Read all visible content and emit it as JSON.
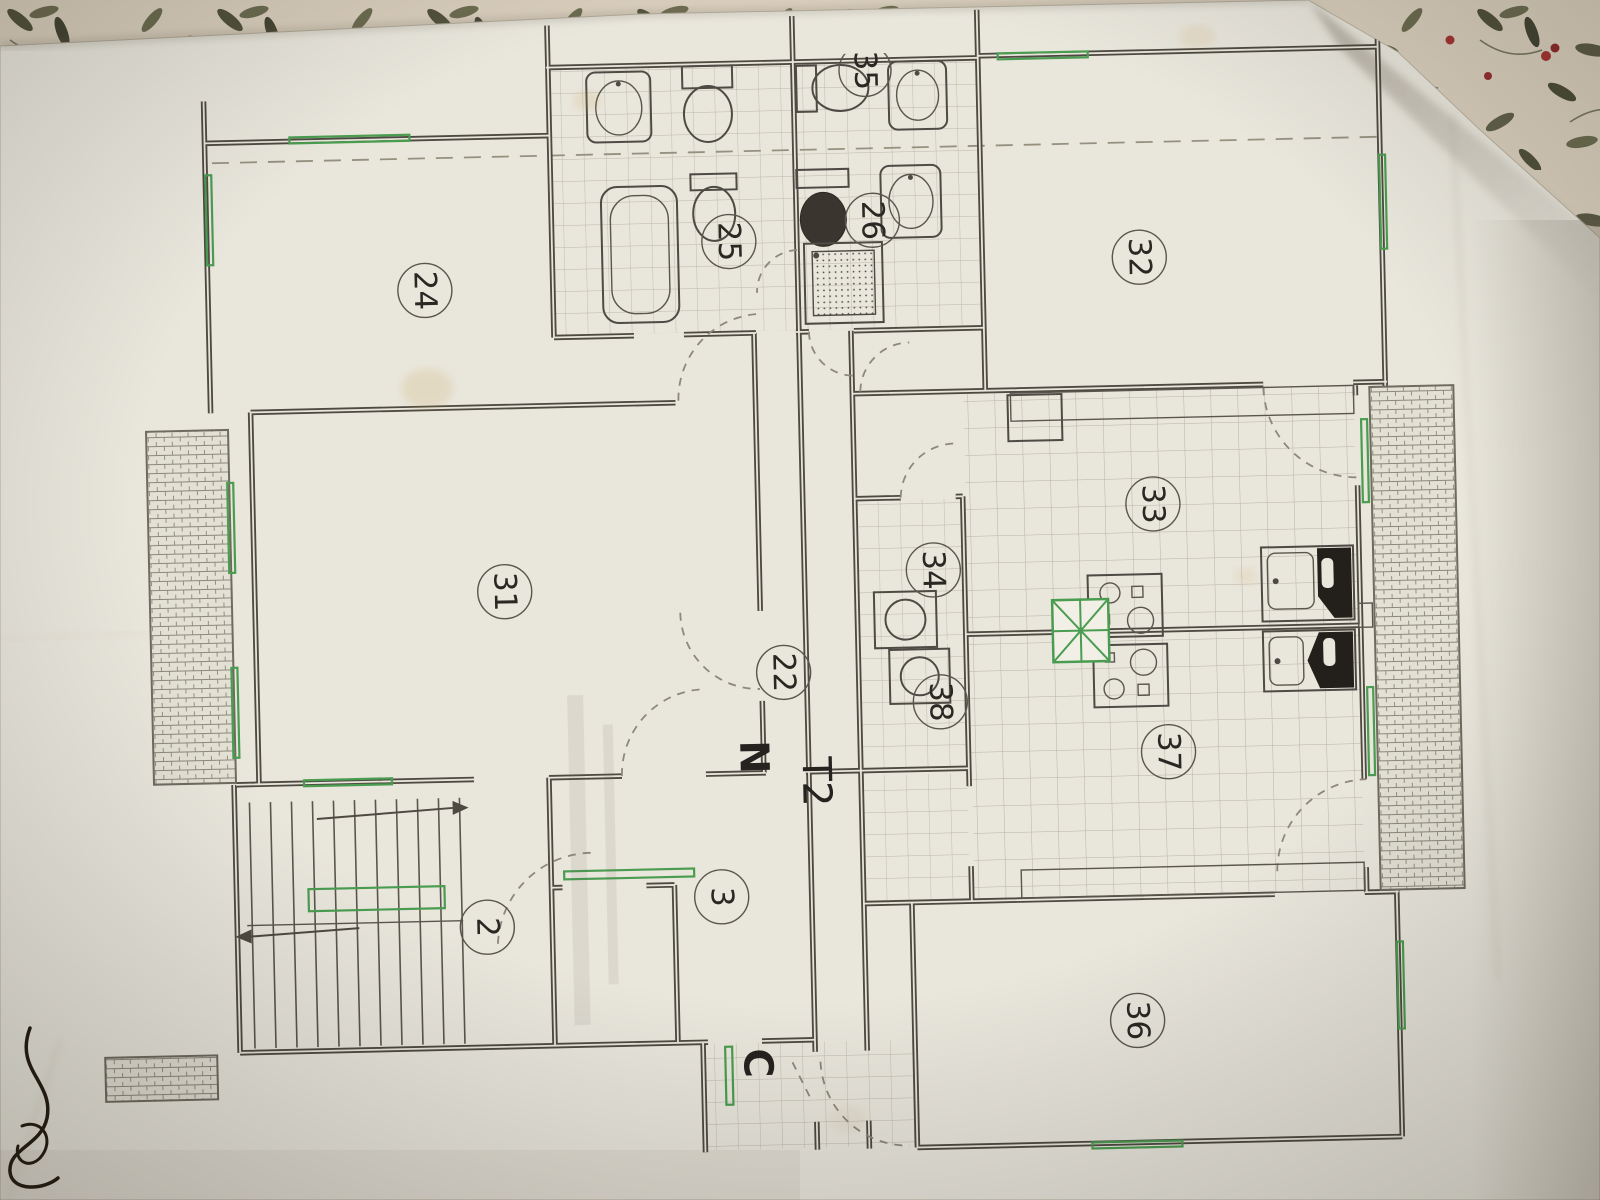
{
  "plan": {
    "unit_label": "T2",
    "north_label": "N",
    "corridor_label": "C",
    "room_numbers": {
      "r2": "2",
      "r3": "3",
      "r22": "22",
      "r24": "24",
      "r25": "25",
      "r26": "26",
      "r31": "31",
      "r32": "32",
      "r33": "33",
      "r34": "34",
      "r35": "35",
      "r36": "36",
      "r37": "37",
      "r38": "38"
    }
  },
  "colors": {
    "paper": "#e9e6dc",
    "plan_line": "#4e4a42",
    "marking_green": "#4a9c50",
    "tile_grid": "#bdb7a9",
    "dashed_section_line": "#96917f",
    "fabric_base": "#d9cebc",
    "fabric_leaf": "#4a4a36",
    "fabric_berry": "#a33434",
    "ink_scribble": "#241c12"
  }
}
